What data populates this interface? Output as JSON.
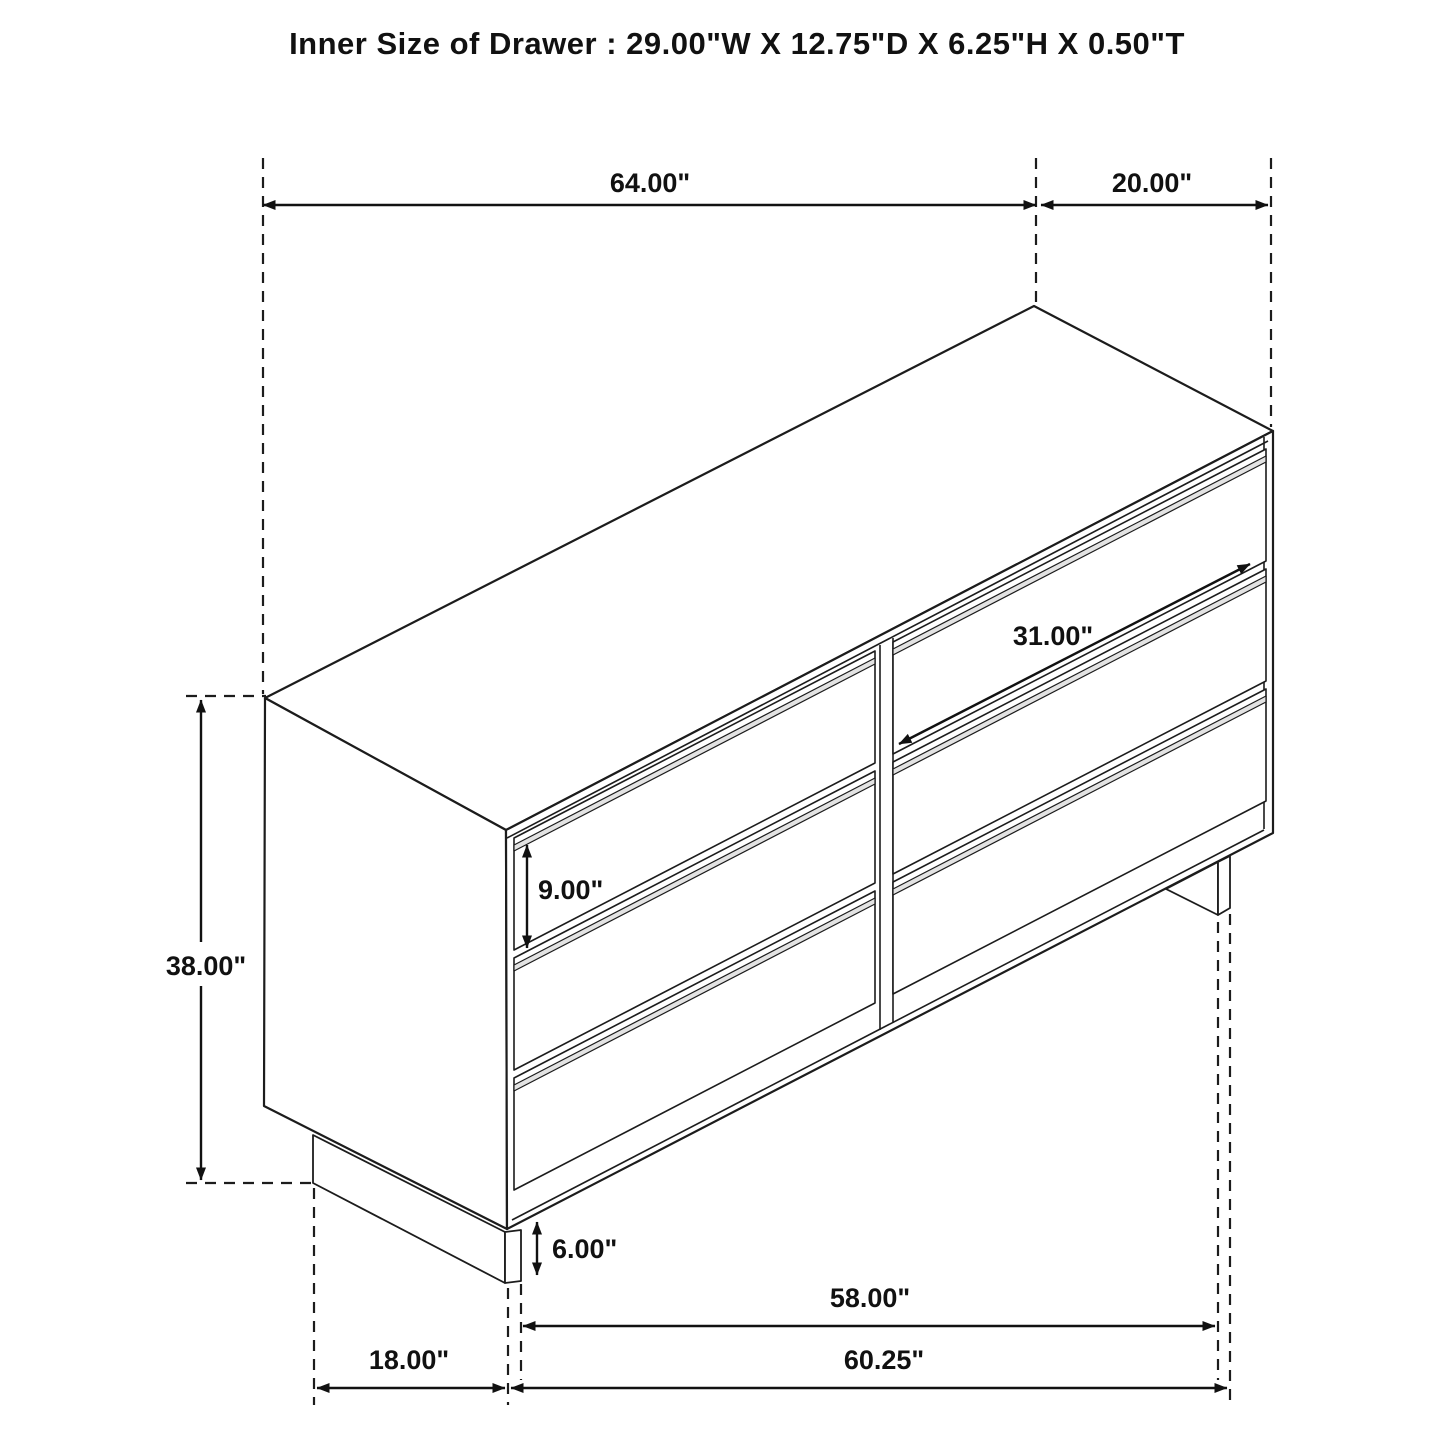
{
  "title": "Inner Size of Drawer : 29.00\"W X 12.75\"D X 6.25\"H X 0.50\"T",
  "figure": {
    "kind": "isometric dimension drawing",
    "subject": "6-drawer dresser",
    "line_color": "#1c1c1c",
    "background": "#ffffff"
  },
  "dimensions": {
    "top_width": {
      "label": "64.00\""
    },
    "depth": {
      "label": "20.00\""
    },
    "height": {
      "label": "38.00\""
    },
    "drawer_width": {
      "label": "31.00\""
    },
    "drawer_height": {
      "label": "9.00\""
    },
    "base_height": {
      "label": "6.00\""
    },
    "base_inner_span": {
      "label": "58.00\""
    },
    "base_width": {
      "label": "60.25\""
    },
    "base_depth": {
      "label": "18.00\""
    }
  }
}
